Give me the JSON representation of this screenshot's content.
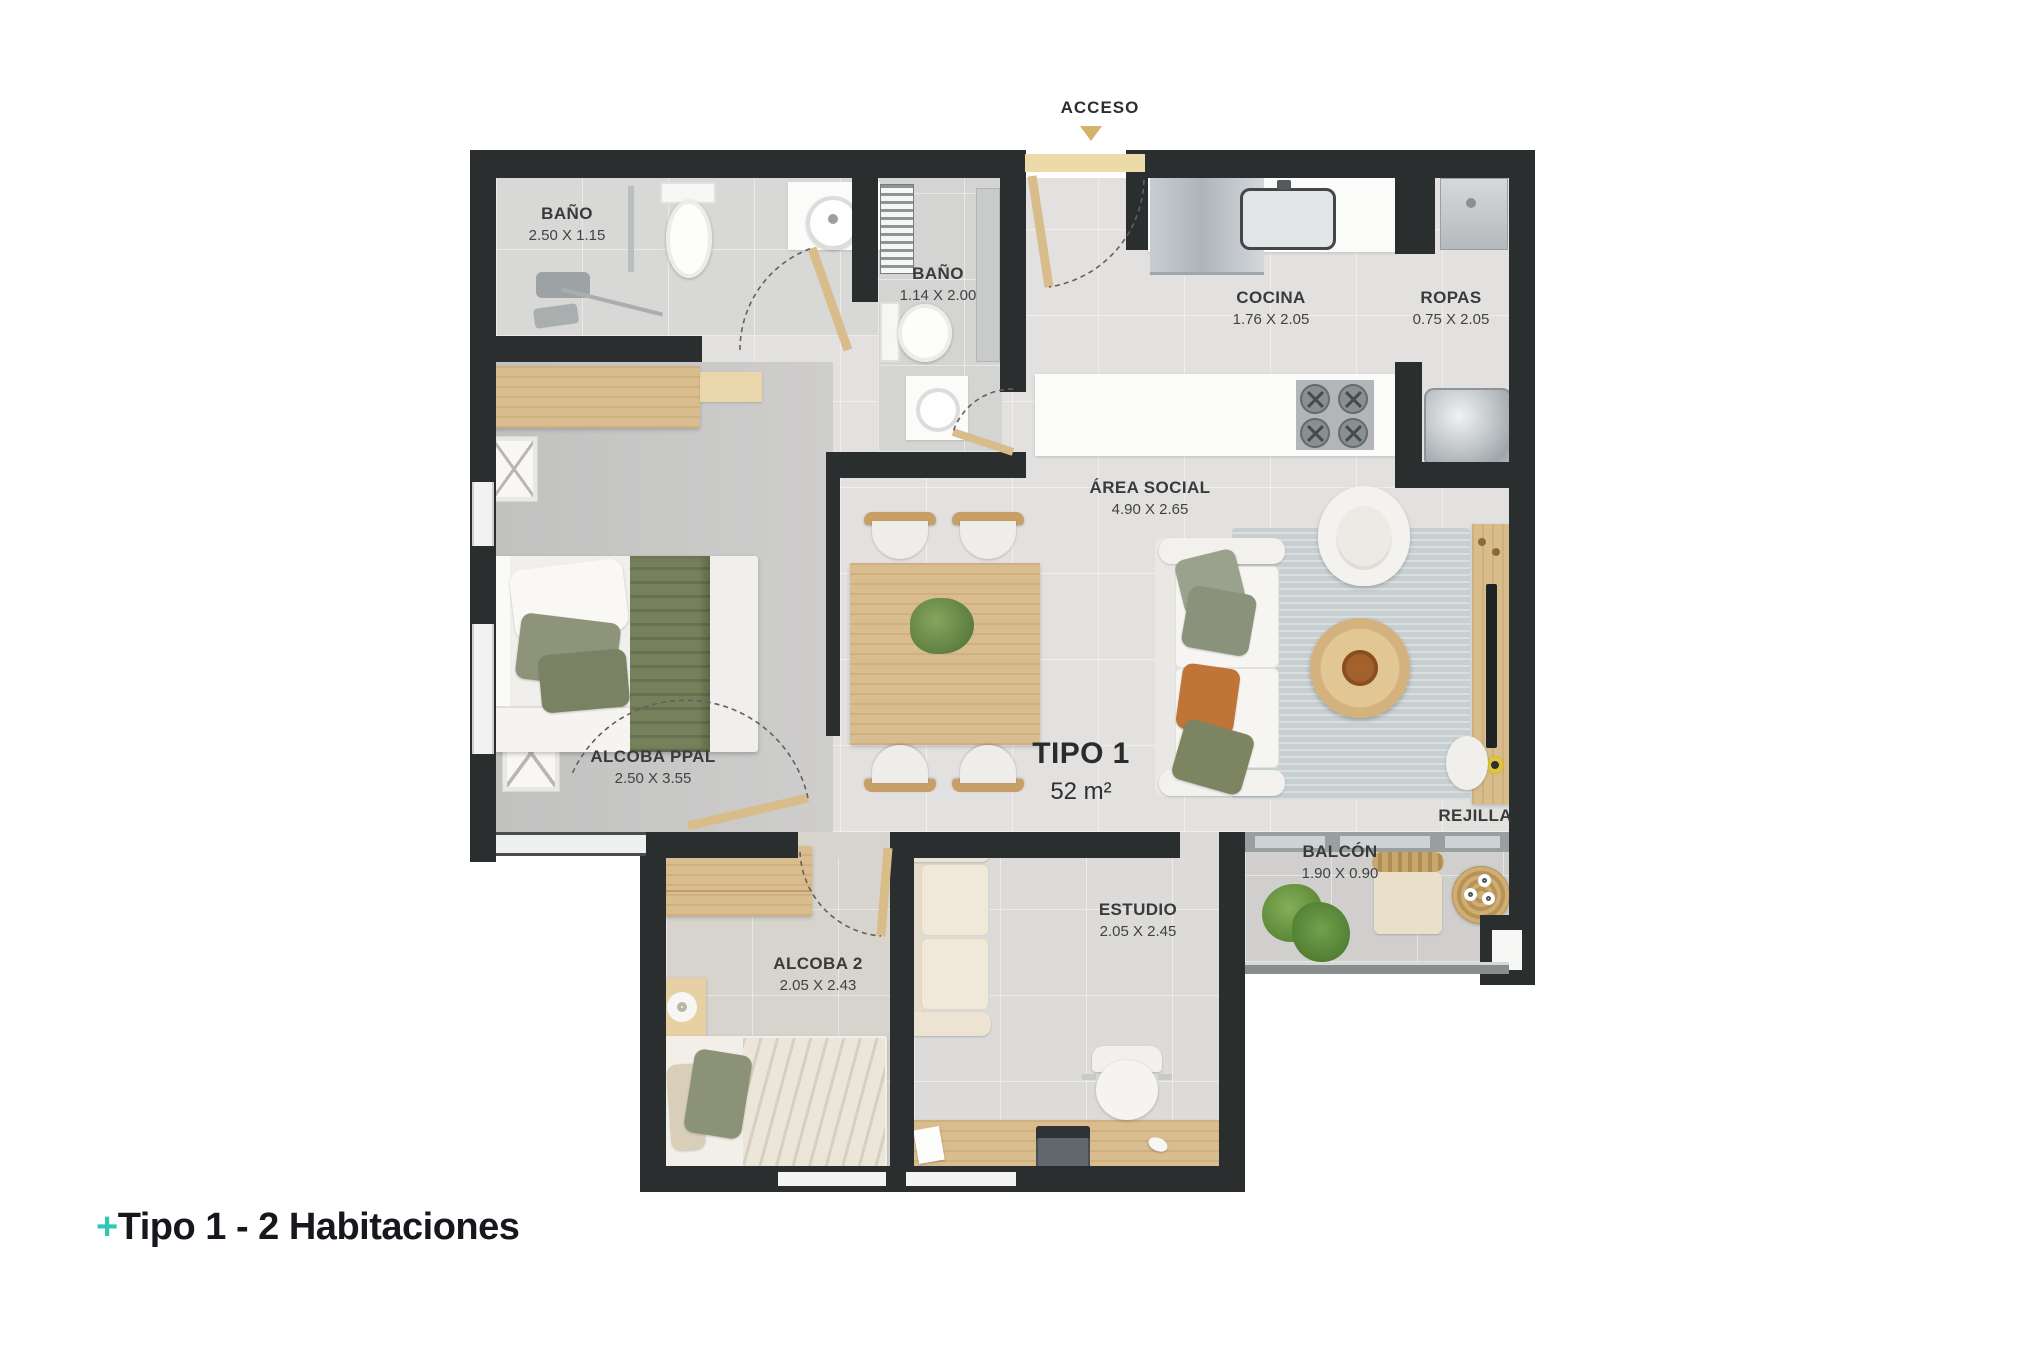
{
  "plan": {
    "title": {
      "name": "TIPO 1",
      "area": "52 m²"
    },
    "rooms": [
      {
        "id": "bano-ppal",
        "name": "BAÑO",
        "dims": "2.50 X 1.15"
      },
      {
        "id": "bano-2",
        "name": "BAÑO",
        "dims": "1.14 X 2.00"
      },
      {
        "id": "cocina",
        "name": "COCINA",
        "dims": "1.76 X 2.05"
      },
      {
        "id": "ropas",
        "name": "ROPAS",
        "dims": "0.75 X 2.05"
      },
      {
        "id": "area-social",
        "name": "ÁREA SOCIAL",
        "dims": "4.90 X 2.65"
      },
      {
        "id": "alcoba-ppal",
        "name": "ALCOBA PPAL",
        "dims": "2.50 X 3.55"
      },
      {
        "id": "alcoba-2",
        "name": "ALCOBA 2",
        "dims": "2.05 X 2.43"
      },
      {
        "id": "estudio",
        "name": "ESTUDIO",
        "dims": "2.05 X 2.45"
      },
      {
        "id": "balcon",
        "name": "BALCÓN",
        "dims": "1.90 X 0.90"
      }
    ],
    "access": {
      "label": "ACCESO"
    },
    "annotations": {
      "rejilla": "REJILLA"
    }
  },
  "caption": {
    "plus": "+",
    "text": "Tipo 1 - 2 Habitaciones"
  },
  "colors": {
    "wall": "#2b2e2f",
    "accent_teal": "#2ec9b4",
    "access_gold": "#d3b269",
    "wood": "#dabd8e",
    "caption_text": "#17171d"
  }
}
